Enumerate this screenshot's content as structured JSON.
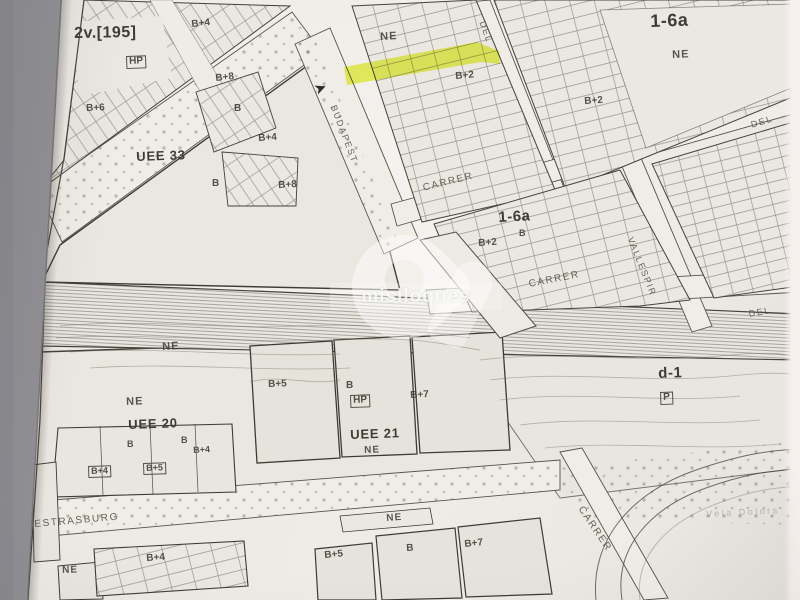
{
  "colors": {
    "background_gray": "#9b999d",
    "paper": "#efece6",
    "ink": "#45413a",
    "highlight_yellow": "#e7f440",
    "right_strip": "#f5efed"
  },
  "watermark": {
    "text": "mislloques"
  },
  "arrow": {
    "glyph": "➤"
  },
  "highlight": {
    "name": "selected-parcel"
  },
  "labels": [
    {
      "text": "2v.[195]",
      "x": 74,
      "y": 26,
      "size": 16,
      "rot": -1,
      "kind": "zone"
    },
    {
      "text": "HP",
      "x": 126,
      "y": 56,
      "size": 10,
      "rot": -2,
      "kind": "boxed"
    },
    {
      "text": "B+4",
      "x": 191,
      "y": 20,
      "size": 10,
      "rot": -6,
      "kind": "plot"
    },
    {
      "text": "B+8",
      "x": 215,
      "y": 74,
      "size": 10,
      "rot": -6,
      "kind": "plot"
    },
    {
      "text": "B+6",
      "x": 86,
      "y": 104,
      "size": 10,
      "rot": -2,
      "kind": "plot"
    },
    {
      "text": "B",
      "x": 234,
      "y": 104,
      "size": 10,
      "rot": 0,
      "kind": "plot"
    },
    {
      "text": "B+4",
      "x": 258,
      "y": 134,
      "size": 10,
      "rot": -4,
      "kind": "plot"
    },
    {
      "text": "UEE 33",
      "x": 136,
      "y": 150,
      "size": 13,
      "rot": -2,
      "kind": "uee"
    },
    {
      "text": "B",
      "x": 212,
      "y": 179,
      "size": 10,
      "rot": 0,
      "kind": "plot"
    },
    {
      "text": "B+8",
      "x": 278,
      "y": 181,
      "size": 10,
      "rot": -3,
      "kind": "plot"
    },
    {
      "text": "NE",
      "x": 380,
      "y": 32,
      "size": 11,
      "rot": -3,
      "kind": "ne"
    },
    {
      "text": "B+2",
      "x": 455,
      "y": 72,
      "size": 10,
      "rot": -5,
      "kind": "plot"
    },
    {
      "text": "DEL",
      "x": 486,
      "y": 20,
      "size": 9,
      "rot": 70,
      "kind": "street"
    },
    {
      "text": "1-6a",
      "x": 650,
      "y": 12,
      "size": 18,
      "rot": -2,
      "kind": "zone"
    },
    {
      "text": "NE",
      "x": 672,
      "y": 50,
      "size": 11,
      "rot": -2,
      "kind": "ne"
    },
    {
      "text": "B+2",
      "x": 584,
      "y": 97,
      "size": 10,
      "rot": -4,
      "kind": "plot"
    },
    {
      "text": "DEL",
      "x": 750,
      "y": 121,
      "size": 9,
      "rot": -17,
      "kind": "street"
    },
    {
      "text": "BUDAPEST",
      "x": 337,
      "y": 104,
      "size": 9,
      "rot": 69,
      "kind": "street"
    },
    {
      "text": "CARRER",
      "x": 422,
      "y": 184,
      "size": 10,
      "rot": -14,
      "kind": "street"
    },
    {
      "text": "1-6a",
      "x": 498,
      "y": 210,
      "size": 15,
      "rot": -3,
      "kind": "zone"
    },
    {
      "text": "B",
      "x": 519,
      "y": 229,
      "size": 9,
      "rot": 0,
      "kind": "plot"
    },
    {
      "text": "B+2",
      "x": 478,
      "y": 239,
      "size": 10,
      "rot": -4,
      "kind": "plot"
    },
    {
      "text": "VALLESPIR",
      "x": 634,
      "y": 236,
      "size": 9,
      "rot": 68,
      "kind": "street"
    },
    {
      "text": "CARRER",
      "x": 528,
      "y": 280,
      "size": 10,
      "rot": -11,
      "kind": "street"
    },
    {
      "text": "DEL",
      "x": 748,
      "y": 310,
      "size": 9,
      "rot": -10,
      "kind": "street"
    },
    {
      "text": "d-1",
      "x": 658,
      "y": 366,
      "size": 15,
      "rot": -2,
      "kind": "zone"
    },
    {
      "text": "P",
      "x": 660,
      "y": 392,
      "size": 10,
      "rot": -2,
      "kind": "boxed"
    },
    {
      "text": "NE",
      "x": 162,
      "y": 342,
      "size": 11,
      "rot": -3,
      "kind": "ne"
    },
    {
      "text": "NE",
      "x": 126,
      "y": 397,
      "size": 11,
      "rot": -2,
      "kind": "ne"
    },
    {
      "text": "UEE 20",
      "x": 128,
      "y": 418,
      "size": 13,
      "rot": -2,
      "kind": "uee"
    },
    {
      "text": "B+5",
      "x": 268,
      "y": 380,
      "size": 10,
      "rot": -2,
      "kind": "plot"
    },
    {
      "text": "B",
      "x": 346,
      "y": 381,
      "size": 10,
      "rot": 0,
      "kind": "plot"
    },
    {
      "text": "HP",
      "x": 350,
      "y": 395,
      "size": 10,
      "rot": -2,
      "kind": "boxed"
    },
    {
      "text": "B+7",
      "x": 410,
      "y": 391,
      "size": 10,
      "rot": -3,
      "kind": "plot"
    },
    {
      "text": "UEE 21",
      "x": 350,
      "y": 428,
      "size": 13,
      "rot": -2,
      "kind": "uee"
    },
    {
      "text": "NE",
      "x": 364,
      "y": 446,
      "size": 10,
      "rot": -2,
      "kind": "ne"
    },
    {
      "text": "B",
      "x": 127,
      "y": 440,
      "size": 9,
      "rot": 0,
      "kind": "plot"
    },
    {
      "text": "B",
      "x": 181,
      "y": 436,
      "size": 9,
      "rot": 0,
      "kind": "plot"
    },
    {
      "text": "B+4",
      "x": 193,
      "y": 446,
      "size": 9,
      "rot": -3,
      "kind": "plot"
    },
    {
      "text": "B+4",
      "x": 88,
      "y": 466,
      "size": 9,
      "rot": -2,
      "kind": "boxed"
    },
    {
      "text": "B+5",
      "x": 143,
      "y": 463,
      "size": 9,
      "rot": -2,
      "kind": "boxed"
    },
    {
      "text": "ESTRASBURG",
      "x": 34,
      "y": 520,
      "size": 10,
      "rot": -5,
      "kind": "street"
    },
    {
      "text": "NE",
      "x": 62,
      "y": 566,
      "size": 10,
      "rot": -2,
      "kind": "ne"
    },
    {
      "text": "B+4",
      "x": 146,
      "y": 554,
      "size": 10,
      "rot": -4,
      "kind": "plot"
    },
    {
      "text": "NE",
      "x": 386,
      "y": 514,
      "size": 10,
      "rot": -4,
      "kind": "ne"
    },
    {
      "text": "B+5",
      "x": 324,
      "y": 551,
      "size": 10,
      "rot": -5,
      "kind": "plot"
    },
    {
      "text": "B",
      "x": 406,
      "y": 544,
      "size": 10,
      "rot": -4,
      "kind": "plot"
    },
    {
      "text": "B+7",
      "x": 464,
      "y": 540,
      "size": 10,
      "rot": -6,
      "kind": "plot"
    },
    {
      "text": "CARRER",
      "x": 584,
      "y": 505,
      "size": 10,
      "rot": 56,
      "kind": "street"
    },
    {
      "text": "Vela Dolors",
      "x": 706,
      "y": 510,
      "size": 9,
      "rot": -3,
      "kind": "faint"
    }
  ]
}
